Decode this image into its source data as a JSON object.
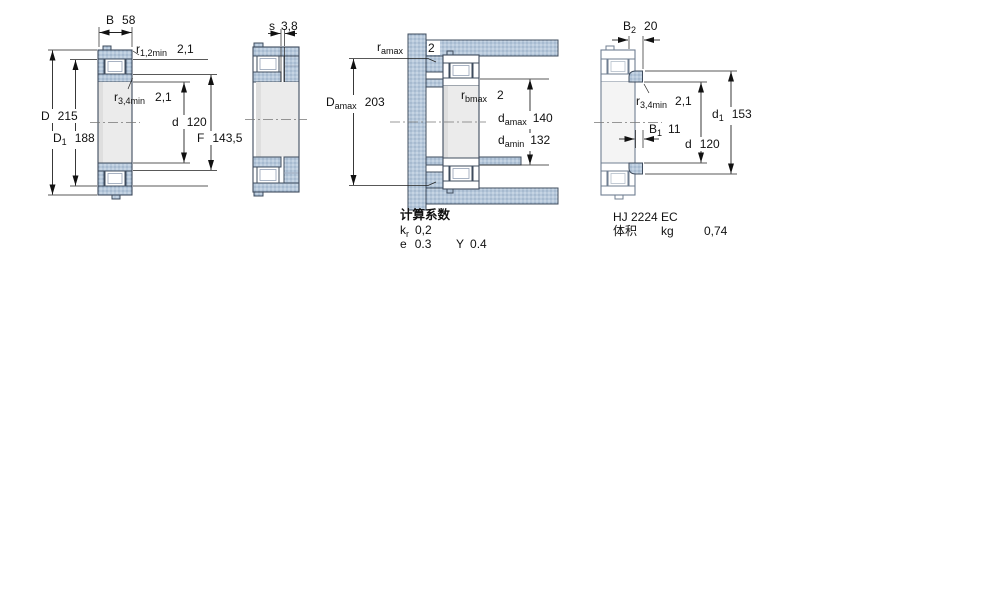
{
  "view1": {
    "dims": {
      "B": {
        "base": "B",
        "value": "58"
      },
      "r12": {
        "base": "r",
        "sub": "1,2min",
        "value": "2,1"
      },
      "r34": {
        "base": "r",
        "sub": "3,4min",
        "value": "2,1"
      },
      "D": {
        "base": "D",
        "value": "215"
      },
      "D1": {
        "base": "D",
        "sub": "1",
        "value": "188"
      },
      "d": {
        "base": "d",
        "value": "120"
      },
      "F": {
        "base": "F",
        "value": "143,5"
      }
    }
  },
  "view2": {
    "dims": {
      "s": {
        "base": "s",
        "value": "3,8"
      }
    }
  },
  "view3": {
    "dims": {
      "r_amax": {
        "base": "r",
        "sub": "amax",
        "value": "2"
      },
      "D_amax": {
        "base": "D",
        "sub": "amax",
        "value": "203"
      },
      "r_bmax": {
        "base": "r",
        "sub": "bmax",
        "value": "2"
      },
      "d_amax": {
        "base": "d",
        "sub": "amax",
        "value": "140"
      },
      "d_amin": {
        "base": "d",
        "sub": "amin",
        "value": "132"
      }
    },
    "calc": {
      "title": "计算系数",
      "kr": {
        "base": "k",
        "sub": "r",
        "value": "0,2"
      },
      "e": {
        "base": "e",
        "value": "0.3"
      },
      "Y": {
        "base": "Y",
        "value": "0.4"
      }
    }
  },
  "view4": {
    "dims": {
      "B2": {
        "base": "B",
        "sub": "2",
        "value": "20"
      },
      "r34": {
        "base": "r",
        "sub": "3,4min",
        "value": "2,1"
      },
      "d1": {
        "base": "d",
        "sub": "1",
        "value": "153"
      },
      "B1": {
        "base": "B",
        "sub": "1",
        "value": "11"
      },
      "d": {
        "base": "d",
        "value": "120"
      }
    },
    "designation": "HJ 2224 EC",
    "mass": {
      "label": "体积",
      "unit": "kg",
      "value": "0,74"
    }
  },
  "colors": {
    "hatch": "#b6c8db",
    "outline": "#3f4c5e",
    "dim_line": "#222222"
  }
}
